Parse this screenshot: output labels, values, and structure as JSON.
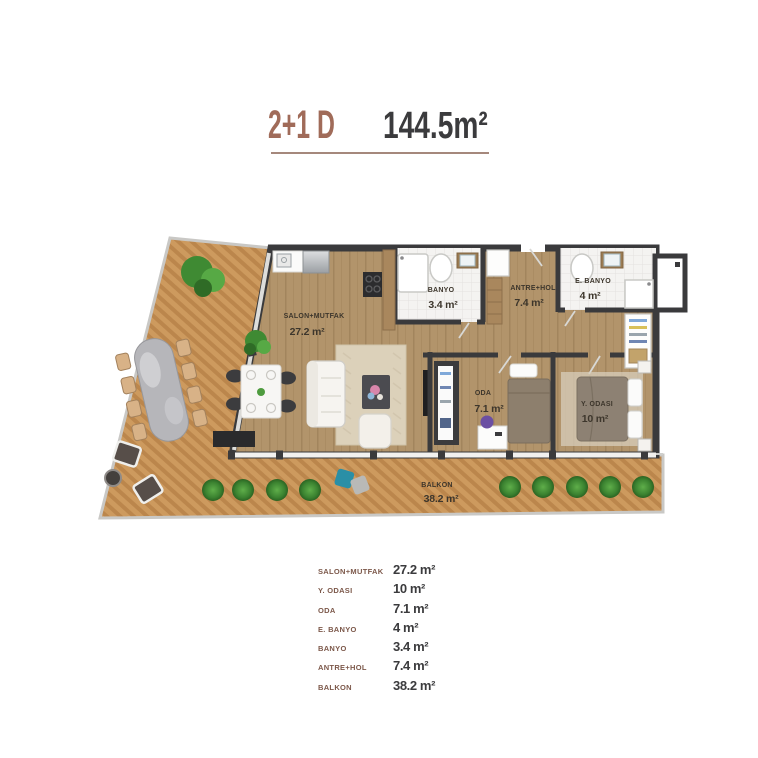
{
  "title": {
    "unit_type": "2+1 D",
    "total_area": "144.5m²"
  },
  "plan": {
    "rooms": [
      {
        "name": "SALON+MUTFAK",
        "area": "27.2 m²"
      },
      {
        "name": "BANYO",
        "area": "3.4 m²"
      },
      {
        "name": "ANTRE+HOL",
        "area": "7.4 m²"
      },
      {
        "name": "E. BANYO",
        "area": "4 m²"
      },
      {
        "name": "ODA",
        "area": "7.1 m²"
      },
      {
        "name": "Y. ODASI",
        "area": "10 m²"
      },
      {
        "name": "BALKON",
        "area": "38.2 m²"
      }
    ]
  },
  "legend": {
    "rows": [
      {
        "label": "SALON+MUTFAK",
        "value": "27.2 m²"
      },
      {
        "label": "Y. ODASI",
        "value": "10 m²"
      },
      {
        "label": "ODA",
        "value": "7.1 m²"
      },
      {
        "label": "E. BANYO",
        "value": "4 m²"
      },
      {
        "label": "BANYO",
        "value": "3.4 m²"
      },
      {
        "label": "ANTRE+HOL",
        "value": "7.4 m²"
      },
      {
        "label": "BALKON",
        "value": "38.2 m²"
      }
    ]
  },
  "colors": {
    "title_brown": "#a06b59",
    "underline": "#a5887c",
    "legend_label": "#7c584a",
    "dark_text": "#3b3b3d",
    "wall": "#3a3a3c",
    "deck_wood": "#cd9a5e",
    "interior_wood": "#b79a6f",
    "tile": "#f4f3f1",
    "bush_green": "#3f8a33"
  }
}
